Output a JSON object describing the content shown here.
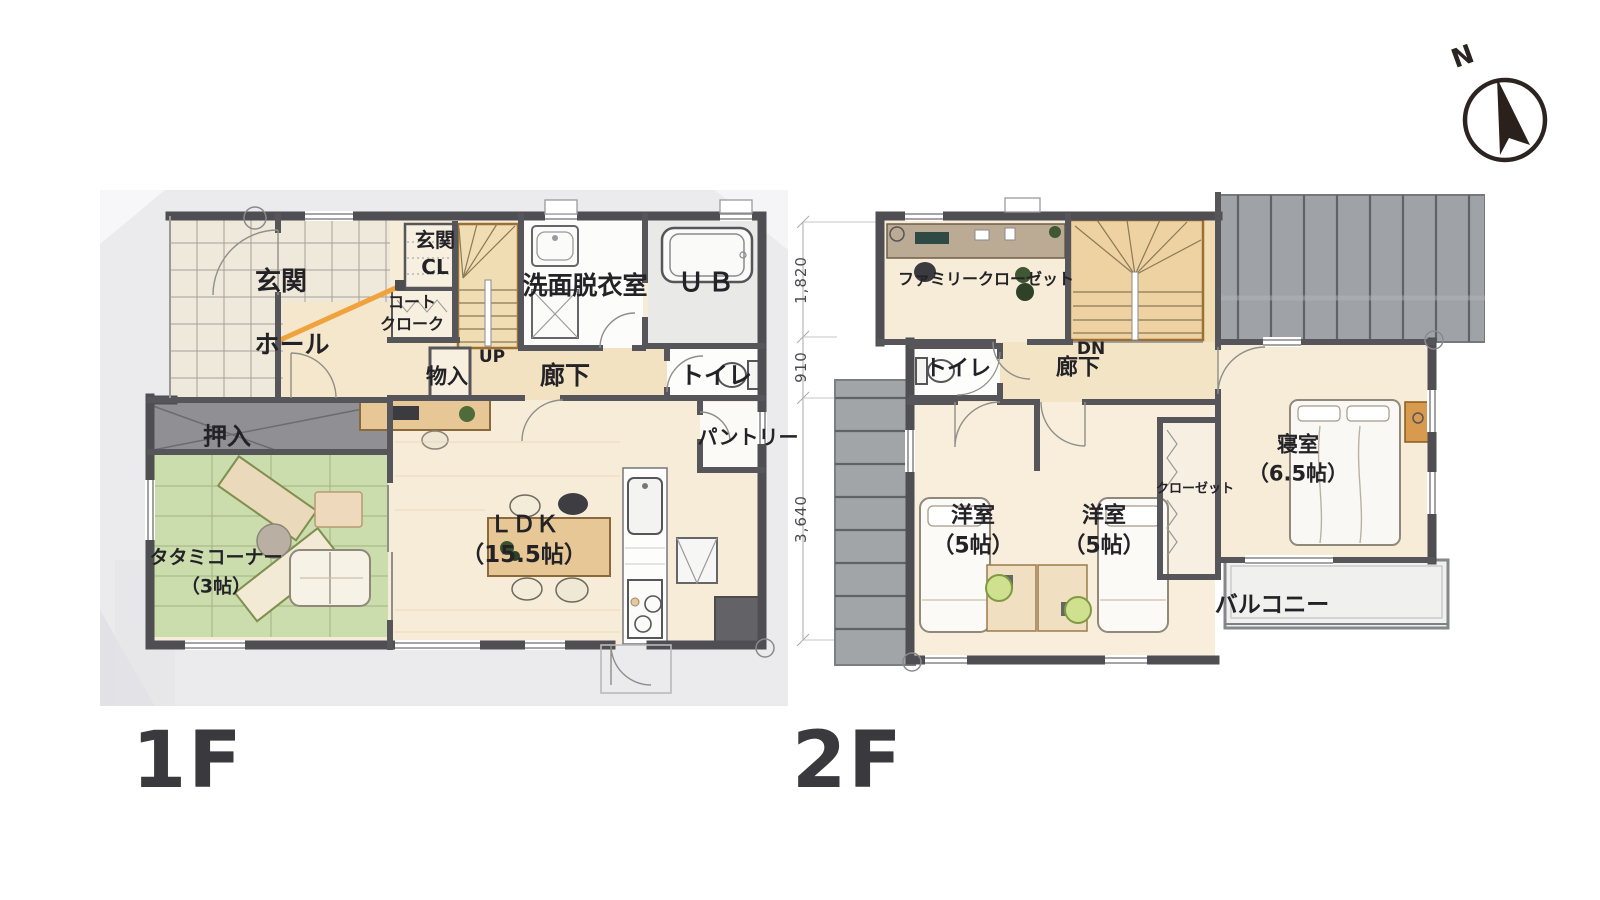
{
  "compass": {
    "north": "N"
  },
  "floor1": {
    "title": "1F",
    "labels": {
      "genkan": "玄関",
      "genkan_cl": "玄関\nCL",
      "coat_cloak": "コート\nクローク",
      "hall": "ホール",
      "up": "UP",
      "storage": "物入",
      "corridor": "廊下",
      "washroom": "洗面脱衣室",
      "bath": "ＵＢ",
      "toilet": "トイレ",
      "pantry": "パントリー",
      "oshiire": "押入",
      "tatami_corner": "タタミコーナー\n（3帖）",
      "ldk": "ＬＤＫ\n（15.5帖）"
    }
  },
  "floor2": {
    "title": "2F",
    "labels": {
      "family_closet": "ファミリークローゼット",
      "down": "DN",
      "corridor": "廊下",
      "toilet": "トイレ",
      "western_room_left": "洋室\n（5帖）",
      "western_room_right": "洋室\n（5帖）",
      "closet": "クローゼット",
      "bedroom": "寝室\n（6.5帖）",
      "balcony": "バルコニー"
    },
    "dimensions": [
      "1,820",
      "910",
      "3,640"
    ]
  }
}
